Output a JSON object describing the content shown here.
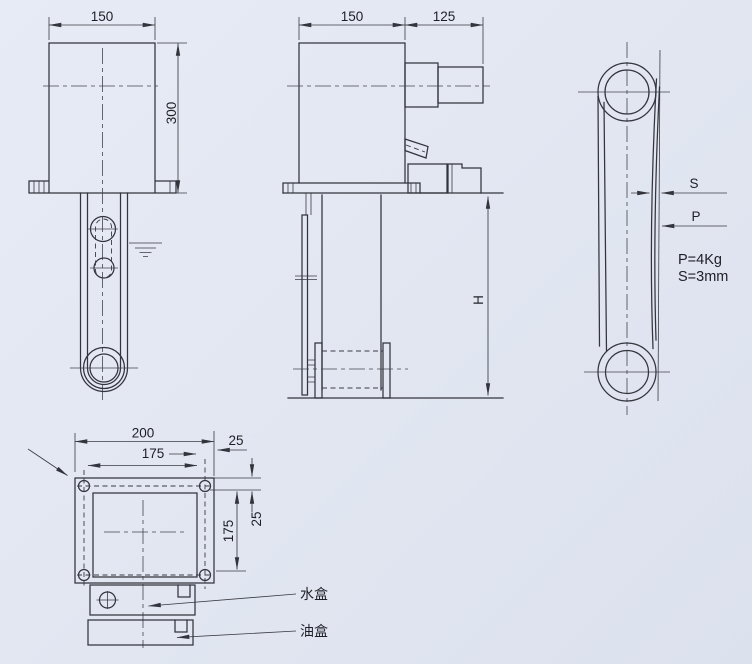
{
  "front_view": {
    "width": "150",
    "height": "300"
  },
  "side_view": {
    "width": "150",
    "shaft_length": "125",
    "depth": "H"
  },
  "belt_view": {
    "deflection_label": "S",
    "force_label": "P",
    "force_spec": "P=4Kg",
    "deflection_spec": "S=3mm"
  },
  "base_view": {
    "overall_width": "200",
    "hole_spacing_width": "175",
    "edge_offset_width": "25",
    "hole_spacing_depth": "175",
    "edge_offset_depth": "25",
    "water_box_label": "水盒",
    "oil_box_label": "油盒"
  }
}
